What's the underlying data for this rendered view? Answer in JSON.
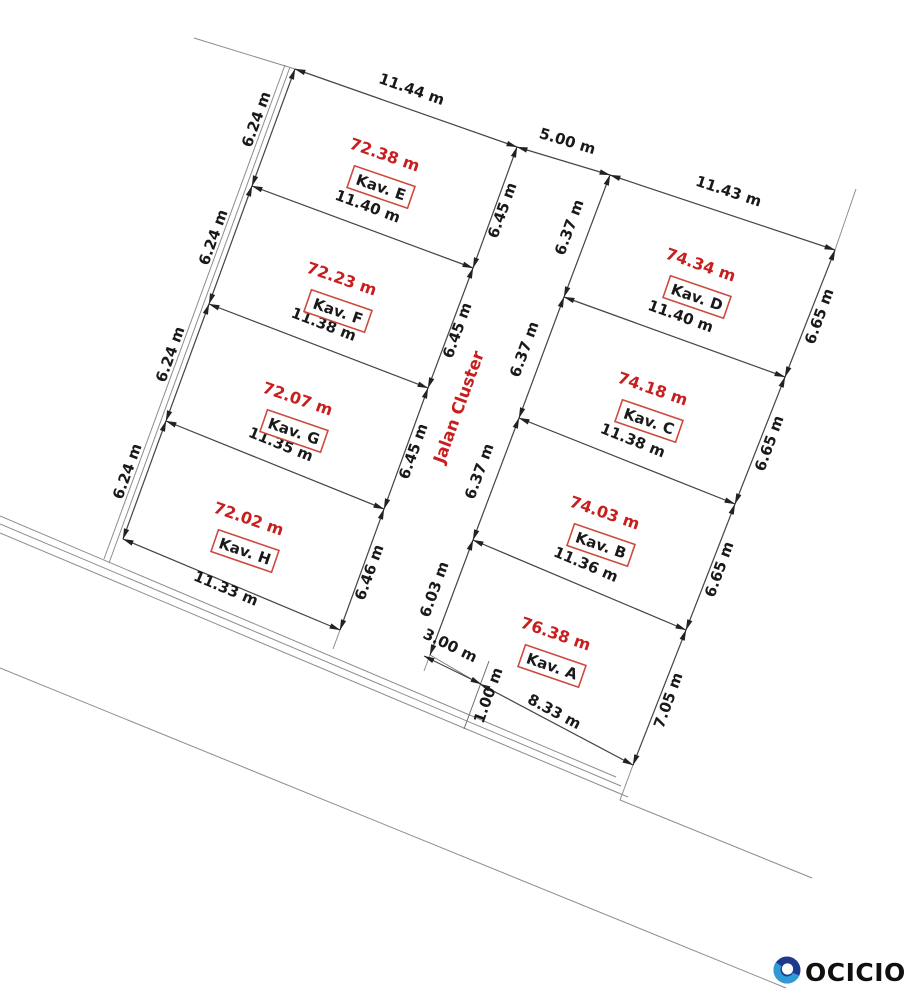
{
  "street": {
    "label": "Jalan Cluster"
  },
  "road": {
    "width_label": "5.00 m",
    "offset_label": "3.00 m",
    "strip_label": "1.00 m"
  },
  "plots": {
    "e": {
      "name": "Kav. E",
      "area": "72.38 m",
      "top": "11.44 m",
      "left": "6.24 m",
      "right": "6.45 m"
    },
    "f": {
      "name": "Kav. F",
      "area": "72.23 m",
      "top": "11.40 m",
      "left": "6.24 m",
      "right": "6.45 m"
    },
    "g": {
      "name": "Kav. G",
      "area": "72.07 m",
      "top": "11.38 m",
      "left": "6.24 m",
      "right": "6.45 m"
    },
    "h": {
      "name": "Kav. H",
      "area": "72.02 m",
      "top": "11.35 m",
      "left": "6.24 m",
      "right": "6.46 m",
      "bottom": "11.33 m"
    },
    "d": {
      "name": "Kav. D",
      "area": "74.34 m",
      "top": "11.43 m",
      "left": "6.37 m",
      "right": "6.65 m"
    },
    "c": {
      "name": "Kav. C",
      "area": "74.18 m",
      "top": "11.40 m",
      "left": "6.37 m",
      "right": "6.65 m"
    },
    "b": {
      "name": "Kav. B",
      "area": "74.03 m",
      "top": "11.38 m",
      "left": "6.37 m",
      "right": "6.65 m"
    },
    "a": {
      "name": "Kav. A",
      "area": "76.38 m",
      "top": "11.36 m",
      "left": "6.03 m",
      "right": "7.05 m",
      "bottom": "8.33 m"
    }
  },
  "colors": {
    "red": "#c81e1e",
    "box_border": "#cd4a3f"
  },
  "logo": {
    "text": "OCICIO",
    "navy": "#1e3a8f",
    "blue": "#2e9bd6"
  }
}
